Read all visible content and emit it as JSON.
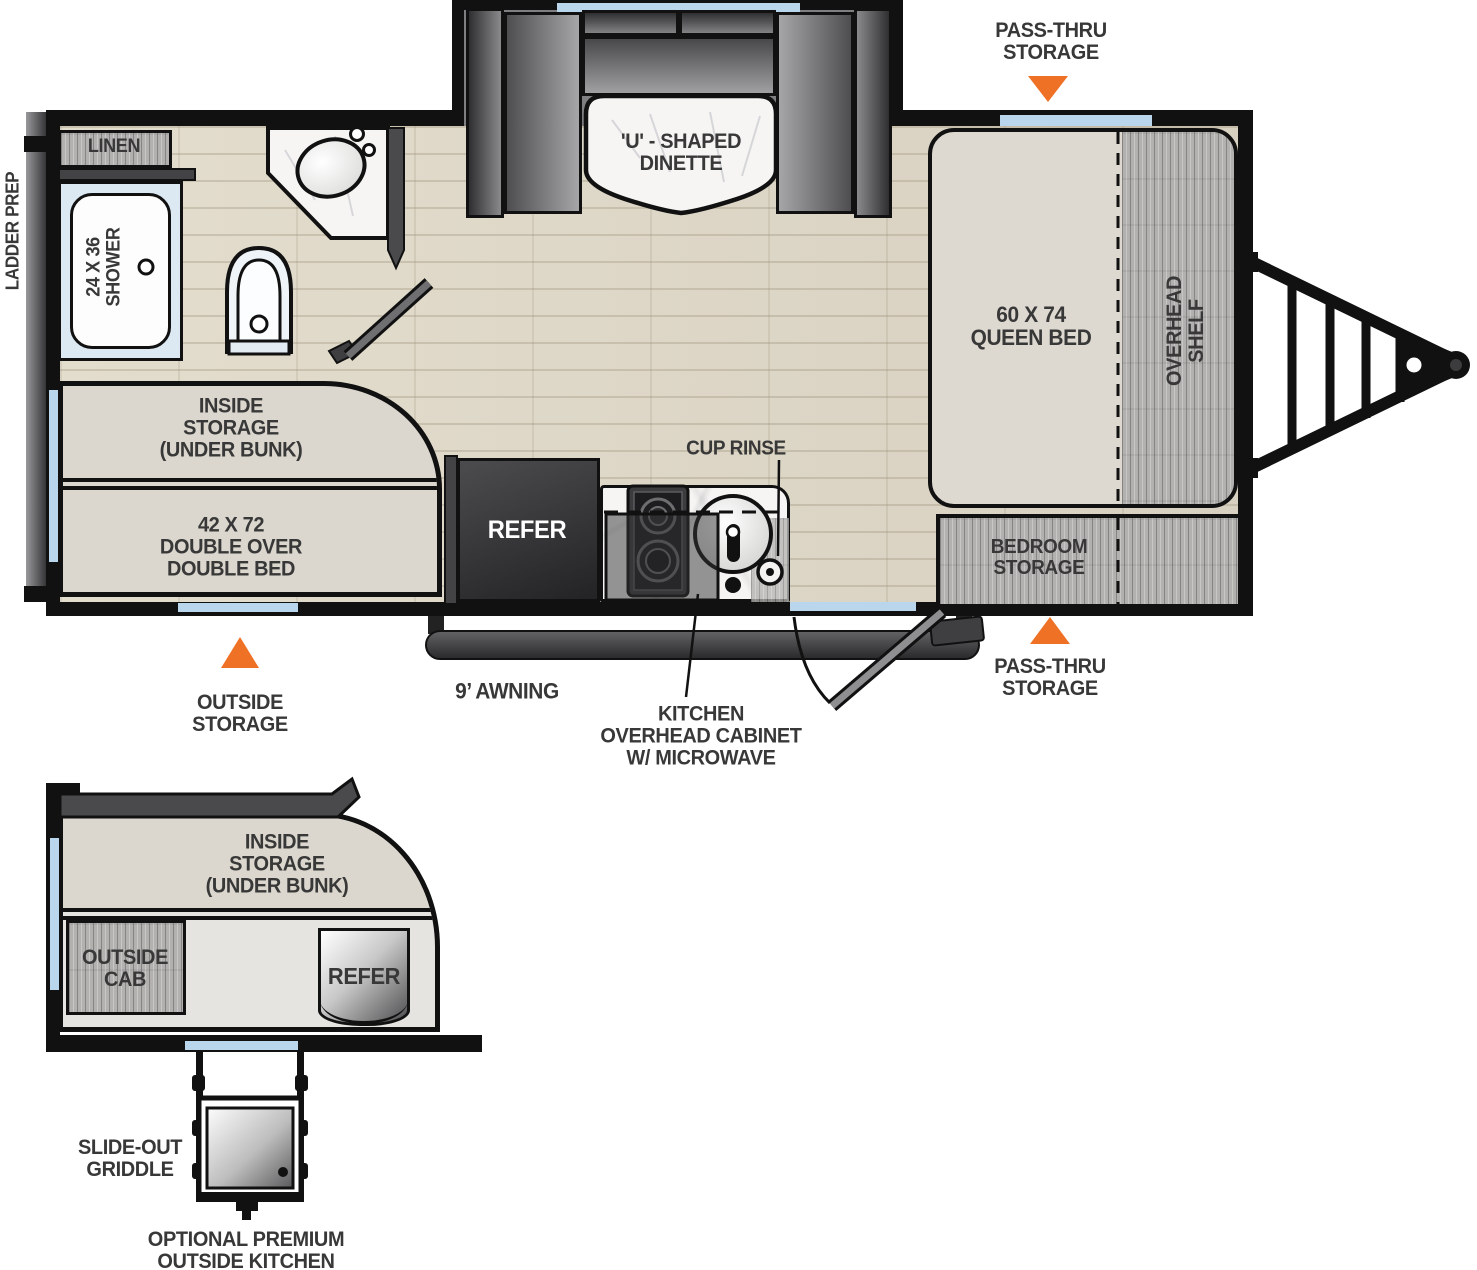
{
  "colors": {
    "accent_orange": "#ef7125",
    "window_blue": "#b9d6ec",
    "label_ink": "#383838"
  },
  "main_floorplan": {
    "callouts": {
      "pass_thru_top": "PASS-THRU\nSTORAGE",
      "pass_thru_bottom": "PASS-THRU\nSTORAGE",
      "outside_storage": "OUTSIDE\nSTORAGE",
      "awning": "9’ AWNING",
      "kitchen_overhead": "KITCHEN\nOVERHEAD CABINET\nW/ MICROWAVE",
      "cup_rinse": "CUP RINSE",
      "ladder_prep": "LADDER PREP"
    },
    "rooms": {
      "dinette": "'U' - SHAPED\nDINETTE",
      "linen": "LINEN",
      "shower": "24 X 36\nSHOWER",
      "queen_bed": "60 X 74\nQUEEN BED",
      "overhead_shelf": "OVERHEAD\nSHELF",
      "inside_storage": "INSIDE\nSTORAGE\n(UNDER BUNK)",
      "double_bed": "42 X 72\nDOUBLE OVER\nDOUBLE BED",
      "refer": "REFER",
      "bedroom_storage": "BEDROOM\nSTORAGE"
    }
  },
  "outside_kitchen_detail": {
    "inside_storage": "INSIDE\nSTORAGE\n(UNDER BUNK)",
    "outside_cab": "OUTSIDE\nCAB",
    "refer": "REFER",
    "slide_out_griddle": "SLIDE-OUT\nGRIDDLE",
    "caption": "OPTIONAL PREMIUM\nOUTSIDE KITCHEN"
  }
}
